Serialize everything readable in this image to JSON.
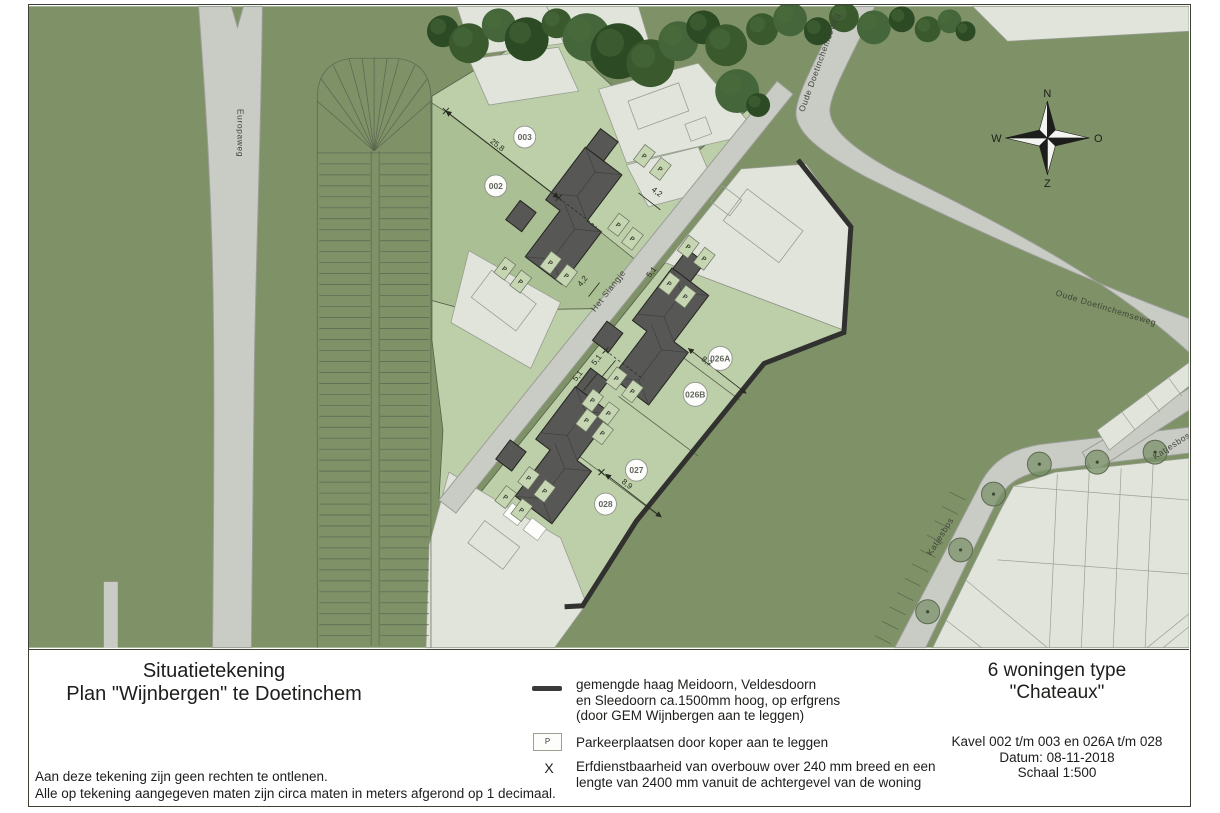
{
  "sheet": {
    "drawing_title_line1": "Situatietekening",
    "drawing_title_line2": "Plan \"Wijnbergen\" te  Doetinchem",
    "note_line1": "Aan deze tekening zijn geen rechten te ontlenen.",
    "note_line2": "Alle op tekening aangegeven maten zijn circa maten in meters afgerond op 1 decimaal.",
    "legend": {
      "hedge_text_line1": "gemengde haag Meidoorn, Veldesdoorn",
      "hedge_text_line2": "en Sleedoorn ca.1500mm hoog, op erfgrens",
      "hedge_text_line3": "(door GEM Wijnbergen aan te leggen)",
      "parking_symbol": "P",
      "parking_text": "Parkeerplaatsen door koper aan te leggen",
      "easement_symbol": "X",
      "easement_text_line1": "Erfdienstbaarheid van overbouw over 240 mm breed en een",
      "easement_text_line2": "lengte van 2400 mm vanuit de achtergevel van de woning"
    },
    "title_block": {
      "project_line1": "6 woningen type",
      "project_line2": "\"Chateaux\"",
      "kavel_info": "Kavel 002 t/m 003 en 026A t/m 028",
      "date": "Datum: 08-11-2018",
      "scale": "Schaal 1:500"
    }
  },
  "map": {
    "streets": {
      "europaweg": "Europaweg",
      "oude_doetinchemseweg": "Oude Doetinchemseweg",
      "het_slangje": "Het Slangje",
      "katjesbos": "Katjesbos"
    },
    "compass": {
      "north": "N",
      "east": "O",
      "south": "Z",
      "west": "W"
    },
    "kavels": [
      "002",
      "003",
      "026A",
      "026B",
      "027",
      "028"
    ],
    "dimensions": [
      {
        "v": "25,8",
        "x": 497,
        "y": 146,
        "rot": 38
      },
      {
        "v": "4,2",
        "x": 657,
        "y": 193,
        "rot": 38
      },
      {
        "v": "4,2",
        "x": 586,
        "y": 282,
        "rot": -52
      },
      {
        "v": "5,1",
        "x": 655,
        "y": 273,
        "rot": -52
      },
      {
        "v": "5,1",
        "x": 600,
        "y": 361,
        "rot": -52
      },
      {
        "v": "5,1",
        "x": 581,
        "y": 377,
        "rot": -52
      },
      {
        "v": "8,7",
        "x": 707,
        "y": 363,
        "rot": 38
      },
      {
        "v": "8,9",
        "x": 627,
        "y": 486,
        "rot": 38
      }
    ],
    "parking_label": "P",
    "parking_spots": [
      [
        646,
        155
      ],
      [
        662,
        168
      ],
      [
        620,
        224
      ],
      [
        634,
        238
      ],
      [
        552,
        262
      ],
      [
        568,
        275
      ],
      [
        506,
        268
      ],
      [
        522,
        281
      ],
      [
        671,
        283
      ],
      [
        687,
        296
      ],
      [
        618,
        378
      ],
      [
        634,
        391
      ],
      [
        588,
        420
      ],
      [
        604,
        433
      ],
      [
        594,
        400
      ],
      [
        610,
        413
      ],
      [
        530,
        478
      ],
      [
        546,
        491
      ],
      [
        507,
        497
      ],
      [
        523,
        510
      ],
      [
        690,
        246
      ],
      [
        706,
        258
      ]
    ],
    "easement_marks": [
      [
        447,
        110
      ],
      [
        560,
        197
      ],
      [
        607,
        350
      ],
      [
        603,
        472
      ]
    ]
  },
  "colors": {
    "base_green": "#7e9167",
    "plot_green_light": "#bccfa9",
    "plot_green": "#aabf94",
    "parcel_grey": "#e0e4da",
    "road_grey": "#c9cbc5",
    "building_grey": "#575755",
    "hedge_dark": "#31312f",
    "tree_green": "#2c4a24",
    "ink": "#1d1d1b"
  }
}
